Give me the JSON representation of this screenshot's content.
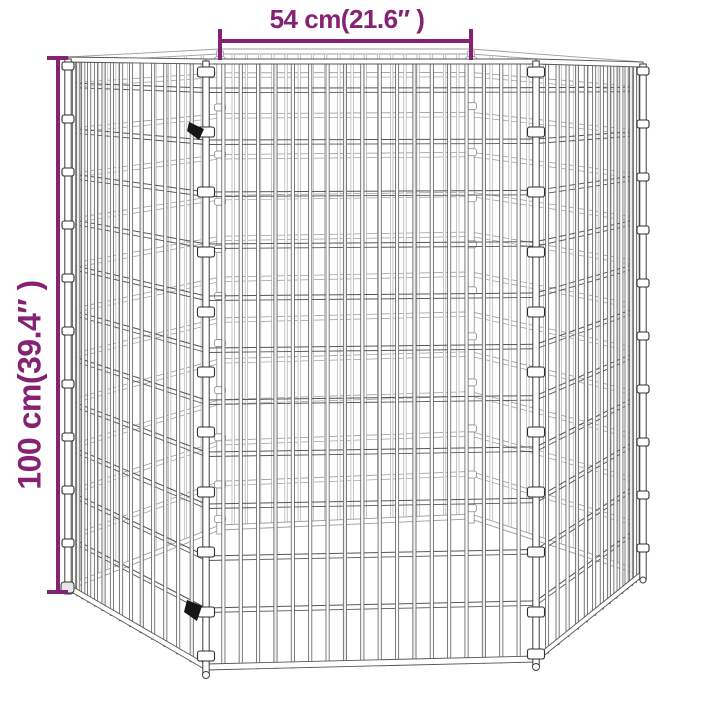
{
  "annotations": {
    "width_label": "54 cm(21.6″ )",
    "height_label": "100 cm(39.4″ )",
    "dimension_color": "#862273"
  },
  "illustration": {
    "subject": "six-panel hexagonal wire mesh pet playpen",
    "wire_dark": "#565656",
    "wire_light": "#9d9d9d",
    "clip_color": "#ffffff",
    "connector_clip_color": "#161616",
    "background_color": "#ffffff"
  }
}
